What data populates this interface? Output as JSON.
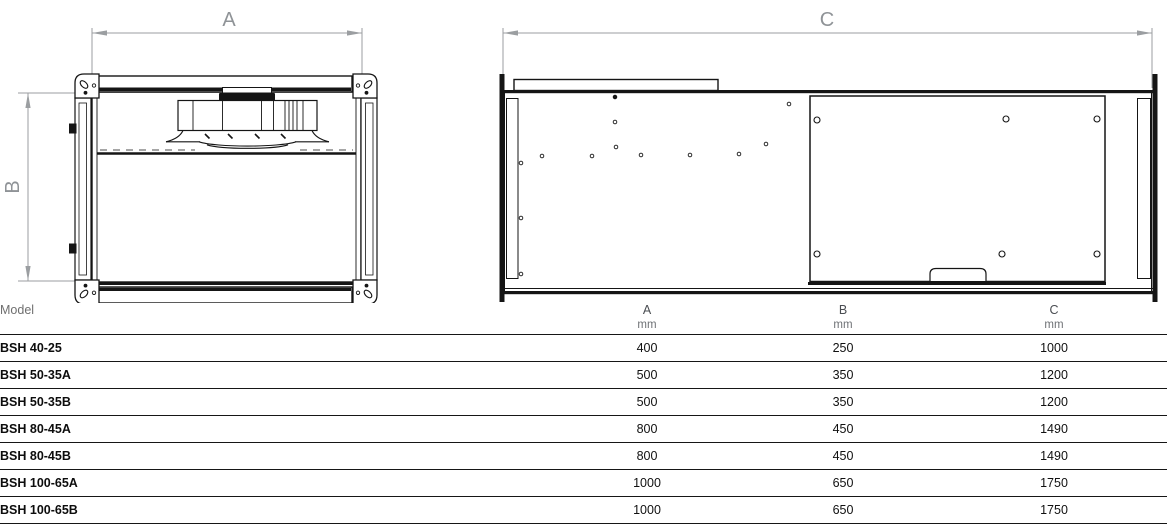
{
  "diagram": {
    "front_view": {
      "width_label": "A",
      "height_label": "B"
    },
    "side_view": {
      "length_label": "C"
    }
  },
  "table": {
    "model_header": "Model",
    "columns": [
      {
        "label": "A",
        "unit": "mm"
      },
      {
        "label": "B",
        "unit": "mm"
      },
      {
        "label": "C",
        "unit": "mm"
      }
    ],
    "rows": [
      {
        "model": "BSH 40-25",
        "a": "400",
        "b": "250",
        "c": "1000"
      },
      {
        "model": "BSH 50-35A",
        "a": "500",
        "b": "350",
        "c": "1200"
      },
      {
        "model": "BSH 50-35B",
        "a": "500",
        "b": "350",
        "c": "1200"
      },
      {
        "model": "BSH 80-45A",
        "a": "800",
        "b": "450",
        "c": "1490"
      },
      {
        "model": "BSH 80-45B",
        "a": "800",
        "b": "450",
        "c": "1490"
      },
      {
        "model": "BSH 100-65A",
        "a": "1000",
        "b": "650",
        "c": "1750"
      },
      {
        "model": "BSH 100-65B",
        "a": "1000",
        "b": "650",
        "c": "1750"
      }
    ]
  },
  "colors": {
    "drawing_line": "#151515",
    "dimension_gray": "#8f9397",
    "table_rule": "#161616",
    "muted_text": "#6f6f6f"
  }
}
